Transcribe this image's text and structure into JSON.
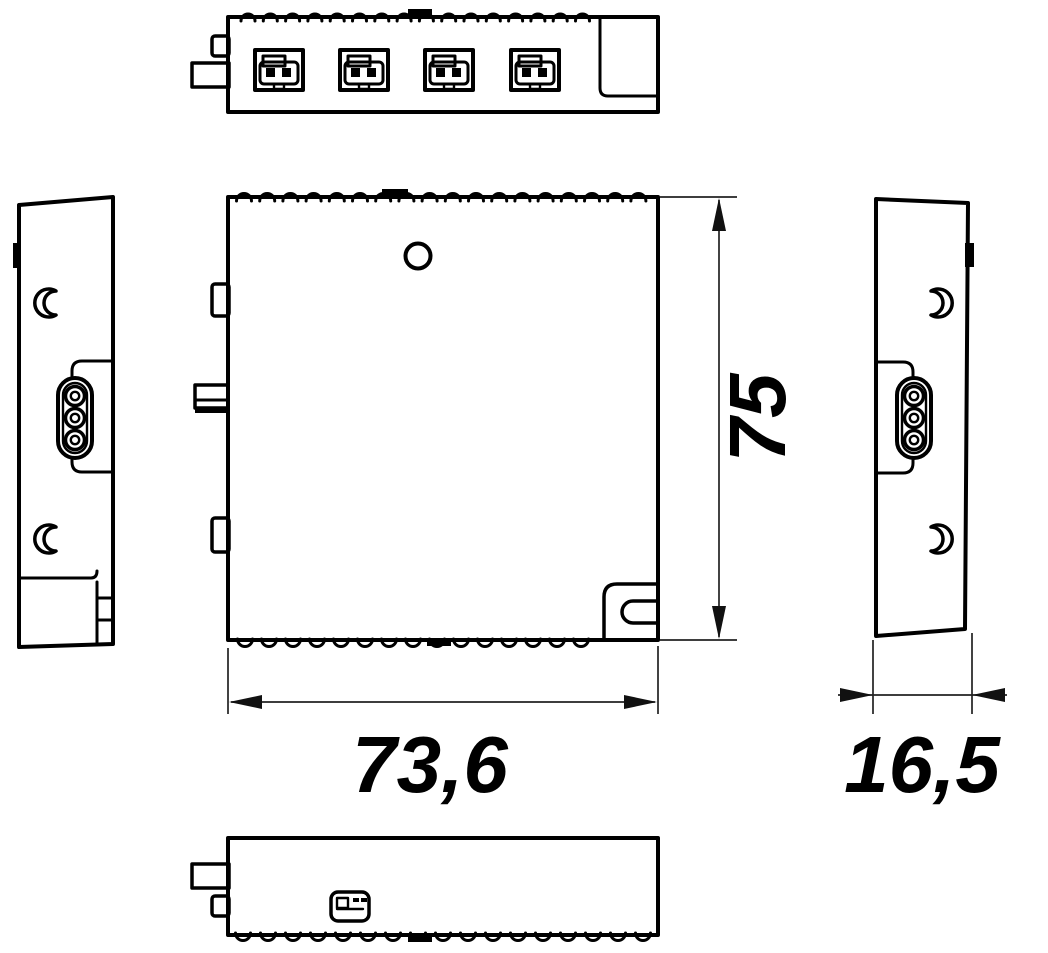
{
  "diagram": {
    "background_color": "#ffffff",
    "line_color": "#000000",
    "dimensions": {
      "height": "75",
      "width": "73,6",
      "depth": "16,5"
    }
  }
}
